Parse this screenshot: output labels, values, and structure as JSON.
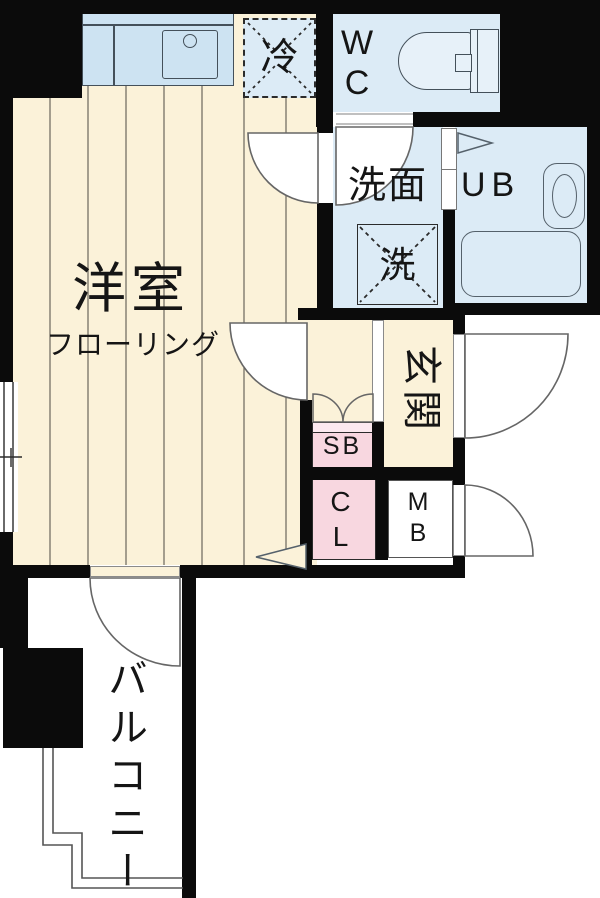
{
  "plan": {
    "type": "apartment-floor-plan",
    "rooms": {
      "western_room": {
        "label": "洋室",
        "floor_note": "フローリング"
      },
      "refrigerator_space": {
        "label": "冷"
      },
      "toilet_room": {
        "label": "WC"
      },
      "washroom": {
        "label": "洗面"
      },
      "washer_space": {
        "label": "洗"
      },
      "unit_bath": {
        "label": "UB"
      },
      "entrance": {
        "label": "玄関"
      },
      "shoe_box": {
        "label": "SB"
      },
      "closet": {
        "label": "CL"
      },
      "meter_box": {
        "label": "MB"
      },
      "balcony": {
        "label": "バルコニー"
      }
    },
    "colors": {
      "floor_beige": "#fbf2d9",
      "wet_area_blue": "#dcebf6",
      "kitchen_counter_blue": "#cde3f2",
      "storage_pink": "#f8d7e0",
      "storage_pink_light": "#fce9ef",
      "wall_black": "#0b0b0b",
      "line_gray": "#666666"
    }
  }
}
